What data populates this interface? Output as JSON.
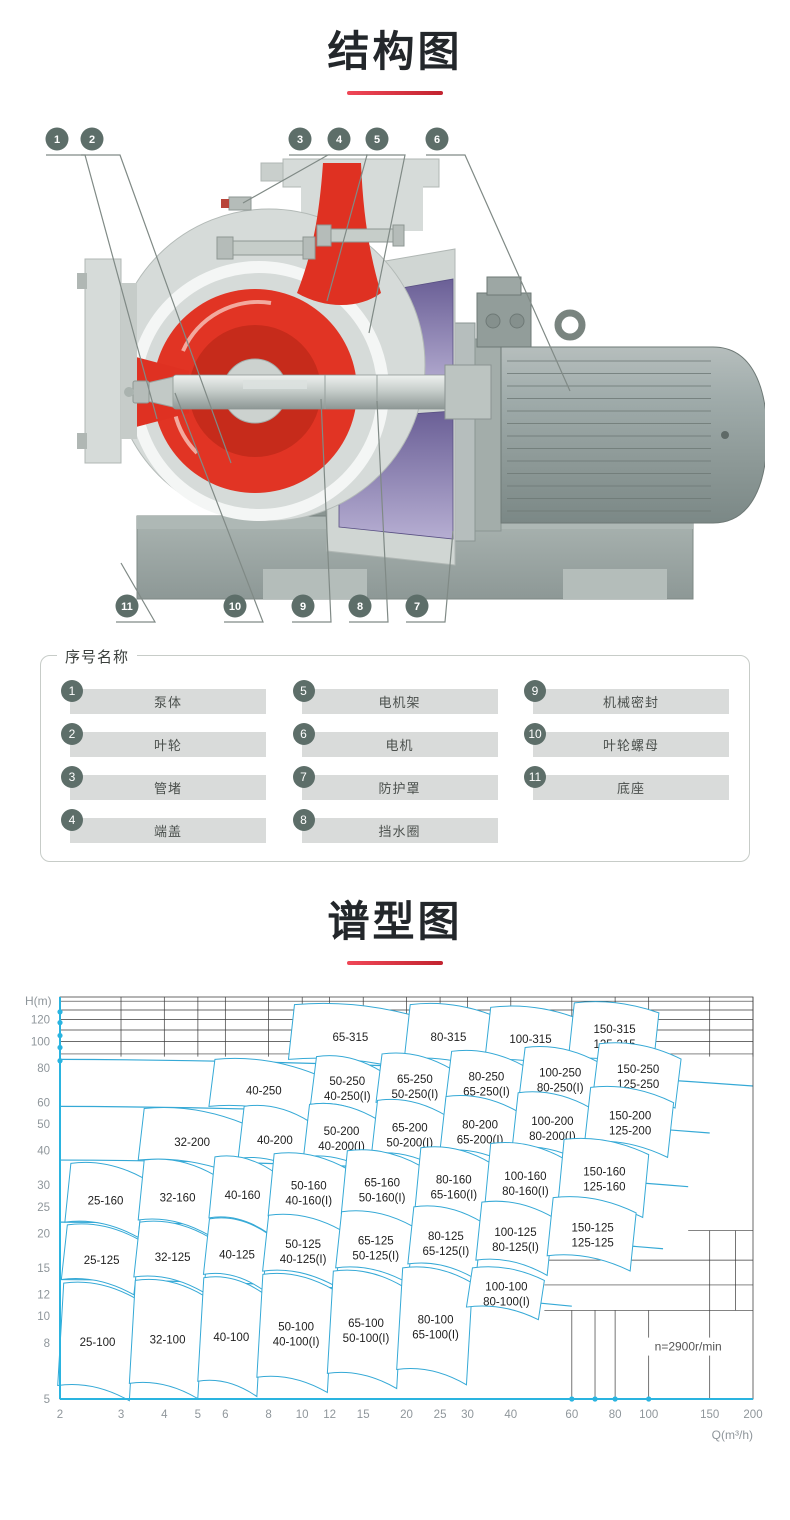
{
  "page": {
    "background": "#ffffff"
  },
  "structure_section": {
    "title": "结构图",
    "colors": {
      "badge": "#5d6e69",
      "red": "#df3122",
      "red_dark": "#c62b1b",
      "purple_dark": "#6a5f96",
      "purple_light": "#b6aed2",
      "casing": "#d6dbd9",
      "casing_edge": "#b0b7b4",
      "motor_light": "#b6bebd",
      "motor_dark": "#7b8886",
      "motor_line": "#6e7976",
      "base": "#9aa5a2",
      "base_dark": "#7e8985",
      "leader": "#808a86"
    },
    "callouts_top": [
      "1",
      "2",
      "3",
      "4",
      "5",
      "6"
    ],
    "callouts_bottom": [
      "11",
      "10",
      "9",
      "8",
      "7"
    ],
    "parts": {
      "header": "序号名称",
      "columns": [
        [
          {
            "num": "1",
            "name": "泵体"
          },
          {
            "num": "2",
            "name": "叶轮"
          },
          {
            "num": "3",
            "name": "管堵"
          },
          {
            "num": "4",
            "name": "端盖"
          }
        ],
        [
          {
            "num": "5",
            "name": "电机架"
          },
          {
            "num": "6",
            "name": "电机"
          },
          {
            "num": "7",
            "name": "防护罩"
          },
          {
            "num": "8",
            "name": "挡水圈"
          }
        ],
        [
          {
            "num": "9",
            "name": "机械密封"
          },
          {
            "num": "10",
            "name": "叶轮螺母"
          },
          {
            "num": "11",
            "name": "底座"
          }
        ]
      ]
    }
  },
  "chart_section": {
    "title": "谱型图"
  },
  "chart_data": {
    "type": "area",
    "title": "谱型图",
    "xlabel": "Q(m³/h)",
    "ylabel": "H(m)",
    "x_scale": "log",
    "y_scale": "log",
    "x_range": [
      2,
      200
    ],
    "y_range": [
      5,
      145
    ],
    "x_ticks": [
      2,
      3,
      4,
      5,
      6,
      8,
      10,
      12,
      15,
      20,
      25,
      30,
      40,
      60,
      80,
      100,
      150,
      200
    ],
    "y_ticks": [
      120,
      100,
      80,
      60,
      50,
      40,
      30,
      25,
      20,
      15,
      12,
      10,
      8,
      5
    ],
    "speed_note": "n=2900r/min",
    "line_color": "#35a9d6",
    "axis_color": "#2ab4e0",
    "grid_color": "#3a3a3a",
    "tick_color": "#8f969b",
    "family_curves": [
      {
        "h_start": 86,
        "q_end": 200
      },
      {
        "h_start": 58,
        "q_end": 150
      },
      {
        "h_start": 37,
        "q_end": 130
      },
      {
        "h_start": 22,
        "q_end": 110
      },
      {
        "h_start": 13.6,
        "q_end": 60
      }
    ],
    "grid": {
      "top_h_lines": [
        90,
        100,
        110,
        120,
        130,
        140
      ],
      "top_v_span_h": [
        88,
        145
      ],
      "bottom_v_lines": [
        {
          "q": 60,
          "h": [
            5,
            10.5
          ]
        },
        {
          "q": 70,
          "h": [
            5,
            10.5
          ]
        },
        {
          "q": 80,
          "h": [
            5,
            10.5
          ]
        },
        {
          "q": 100,
          "h": [
            5,
            10.5
          ]
        },
        {
          "q": 150,
          "h": [
            5,
            20.5
          ]
        },
        {
          "q": 178,
          "h": [
            10.5,
            20.5
          ]
        }
      ],
      "bottom_h_lines": [
        {
          "h": 10.5,
          "q": [
            50,
            200
          ]
        },
        {
          "h": 13,
          "q": [
            50,
            200
          ]
        },
        {
          "h": 16,
          "q": [
            50,
            200
          ]
        },
        {
          "h": 20.5,
          "q": [
            130,
            200
          ]
        }
      ]
    },
    "axis_dots_left_h": [
      85,
      95,
      105,
      117,
      128
    ],
    "axis_dots_bottom_q": [
      60,
      70,
      80,
      100
    ],
    "regions": [
      {
        "labels": [
          "65-315"
        ],
        "q": [
          9.5,
          20.5
        ],
        "h": [
          86,
          136
        ],
        "tilt": 0.92
      },
      {
        "labels": [
          "80-315"
        ],
        "q": [
          20.5,
          35
        ],
        "h": [
          86,
          136
        ],
        "tilt": 0.92
      },
      {
        "labels": [
          "100-315"
        ],
        "q": [
          35,
          61
        ],
        "h": [
          85,
          133
        ],
        "tilt": 0.92
      },
      {
        "labels": [
          "150-315",
          "125-315"
        ],
        "q": [
          61,
          107
        ],
        "h": [
          86,
          138
        ],
        "tilt": 0.92
      },
      {
        "labels": [
          "40-250"
        ],
        "q": [
          5.6,
          11
        ],
        "h": [
          58,
          86
        ]
      },
      {
        "labels": [
          "50-250",
          "40-250(I)"
        ],
        "q": [
          11,
          17
        ],
        "h": [
          59,
          88
        ]
      },
      {
        "labels": [
          "65-250",
          "50-250(I)"
        ],
        "q": [
          17,
          27
        ],
        "h": [
          60,
          90
        ]
      },
      {
        "labels": [
          "80-250",
          "65-250(I)"
        ],
        "q": [
          27,
          44
        ],
        "h": [
          61,
          92
        ]
      },
      {
        "labels": [
          "100-250",
          "80-250(I)"
        ],
        "q": [
          44,
          72
        ],
        "h": [
          63,
          95
        ]
      },
      {
        "labels": [
          "150-250",
          "125-250"
        ],
        "q": [
          72,
          124
        ],
        "h": [
          65,
          98
        ]
      },
      {
        "labels": [
          "32-200"
        ],
        "q": [
          3.5,
          6.8
        ],
        "h": [
          37,
          57
        ]
      },
      {
        "labels": [
          "40-200"
        ],
        "q": [
          6.8,
          10.5
        ],
        "h": [
          37.5,
          58
        ]
      },
      {
        "labels": [
          "50-200",
          "40-200(I)"
        ],
        "q": [
          10.5,
          16.5
        ],
        "h": [
          38,
          59
        ]
      },
      {
        "labels": [
          "65-200",
          "50-200(I)"
        ],
        "q": [
          16.5,
          26
        ],
        "h": [
          39,
          61
        ]
      },
      {
        "labels": [
          "80-200",
          "65-200(I)"
        ],
        "q": [
          26,
          42
        ],
        "h": [
          40,
          63
        ]
      },
      {
        "labels": [
          "100-200",
          "80-200(I)"
        ],
        "q": [
          42,
          68
        ],
        "h": [
          41,
          65
        ]
      },
      {
        "labels": [
          "150-200",
          "125-200"
        ],
        "q": [
          68,
          118
        ],
        "h": [
          43,
          68
        ]
      },
      {
        "labels": [
          "25-160"
        ],
        "q": [
          2.15,
          3.5
        ],
        "h": [
          22,
          36
        ]
      },
      {
        "labels": [
          "32-160"
        ],
        "q": [
          3.5,
          5.6
        ],
        "h": [
          22.4,
          37
        ]
      },
      {
        "labels": [
          "40-160"
        ],
        "q": [
          5.6,
          8.3
        ],
        "h": [
          22.8,
          38
        ]
      },
      {
        "labels": [
          "50-160",
          "40-160(I)"
        ],
        "q": [
          8.3,
          13.5
        ],
        "h": [
          23.2,
          39
        ]
      },
      {
        "labels": [
          "65-160",
          "50-160(I)"
        ],
        "q": [
          13.5,
          22
        ],
        "h": [
          23.7,
          40
        ]
      },
      {
        "labels": [
          "80-160",
          "65-160(I)"
        ],
        "q": [
          22,
          35
        ],
        "h": [
          24.3,
          41
        ]
      },
      {
        "labels": [
          "100-160",
          "80-160(I)"
        ],
        "q": [
          35,
          57
        ],
        "h": [
          25,
          42.5
        ]
      },
      {
        "labels": [
          "150-160",
          "125-160"
        ],
        "q": [
          57,
          100
        ],
        "h": [
          26,
          44
        ]
      },
      {
        "labels": [
          "25-125"
        ],
        "q": [
          2.1,
          3.4
        ],
        "h": [
          13.6,
          21.5
        ]
      },
      {
        "labels": [
          "32-125"
        ],
        "q": [
          3.4,
          5.4
        ],
        "h": [
          13.9,
          22
        ]
      },
      {
        "labels": [
          "40-125"
        ],
        "q": [
          5.4,
          8
        ],
        "h": [
          14.2,
          22.6
        ]
      },
      {
        "labels": [
          "50-125",
          "40-125(I)"
        ],
        "q": [
          8,
          13
        ],
        "h": [
          14.6,
          23.3
        ]
      },
      {
        "labels": [
          "65-125",
          "50-125(I)"
        ],
        "q": [
          13,
          21
        ],
        "h": [
          15,
          24
        ]
      },
      {
        "labels": [
          "80-125",
          "65-125(I)"
        ],
        "q": [
          21,
          33
        ],
        "h": [
          15.5,
          25
        ]
      },
      {
        "labels": [
          "100-125",
          "80-125(I)"
        ],
        "q": [
          33,
          53
        ],
        "h": [
          16,
          26
        ]
      },
      {
        "labels": [
          "150-125",
          "125-125"
        ],
        "q": [
          53,
          92
        ],
        "h": [
          16.6,
          27
        ]
      },
      {
        "labels": [
          "25-100"
        ],
        "q": [
          2.05,
          3.3
        ],
        "h": [
          5.6,
          13.2
        ]
      },
      {
        "labels": [
          "32-100"
        ],
        "q": [
          3.3,
          5.2
        ],
        "h": [
          5.7,
          13.5
        ]
      },
      {
        "labels": [
          "40-100"
        ],
        "q": [
          5.2,
          7.7
        ],
        "h": [
          5.8,
          13.8
        ]
      },
      {
        "labels": [
          "50-100",
          "40-100(I)"
        ],
        "q": [
          7.7,
          12.3
        ],
        "h": [
          6,
          14.2
        ]
      },
      {
        "labels": [
          "65-100",
          "50-100(I)"
        ],
        "q": [
          12.3,
          19.5
        ],
        "h": [
          6.2,
          14.6
        ]
      },
      {
        "labels": [
          "80-100",
          "65-100(I)"
        ],
        "q": [
          19.5,
          31
        ],
        "h": [
          6.4,
          15
        ]
      },
      {
        "labels": [
          "100-100",
          "80-100(I)"
        ],
        "q": [
          31,
          50
        ],
        "h": [
          10.8,
          15
        ],
        "tilt": 0.9
      }
    ]
  }
}
